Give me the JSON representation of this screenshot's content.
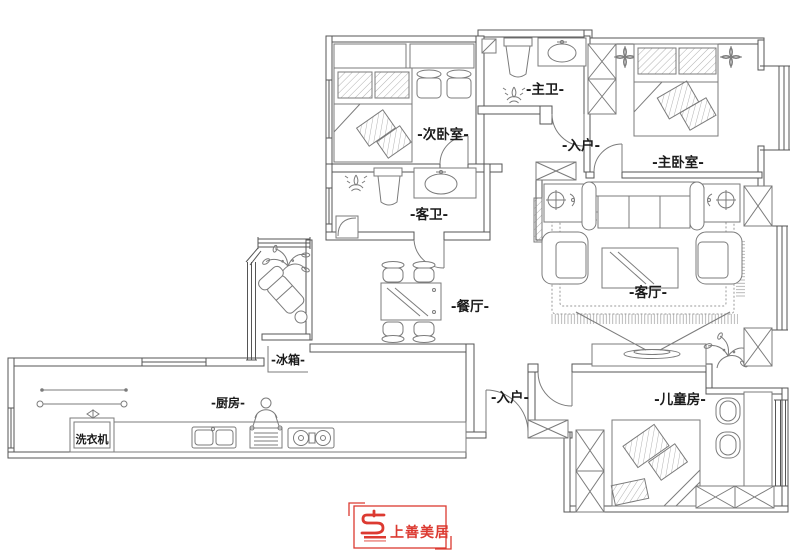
{
  "plan": {
    "rooms": {
      "secondary_bedroom": "-次卧室-",
      "master_bathroom": "-主卫-",
      "entry_upper": "-入户-",
      "master_bedroom": "-主卧室-",
      "guest_bathroom": "-客卫-",
      "dining_room": "-餐厅-",
      "living_room": "-客厅-",
      "refrigerator": "-冰箱-",
      "kitchen": "-厨房-",
      "washing_machine": "洗衣机",
      "entry_lower": "-入户-",
      "children_room": "-儿童房-"
    }
  },
  "logo": {
    "brand": "上善美居"
  },
  "colors": {
    "wall_line": "#555555",
    "furniture_line": "#7b7b7b",
    "label_text": "#1b1b1b",
    "logo_red": "#dc3a31",
    "background": "#ffffff"
  }
}
